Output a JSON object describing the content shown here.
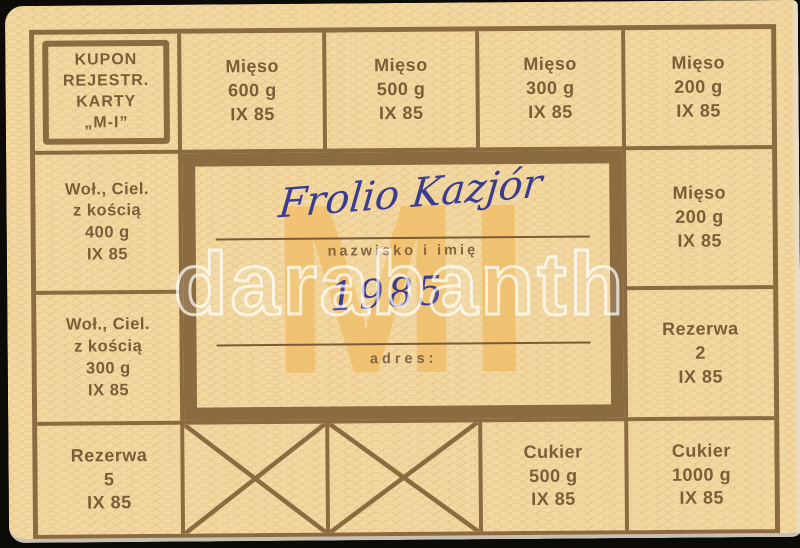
{
  "card": {
    "title_box": {
      "lines": [
        "KUPON",
        "REJESTR.",
        "KARTY",
        "„M-I”"
      ]
    },
    "coupons": {
      "top": [
        [
          "Mięso",
          "600 g",
          "IX 85"
        ],
        [
          "Mięso",
          "500 g",
          "IX 85"
        ],
        [
          "Mięso",
          "300 g",
          "IX 85"
        ],
        [
          "Mięso",
          "200 g",
          "IX 85"
        ]
      ],
      "left": [
        [
          "Woł., Ciel.",
          "z kością",
          "400 g",
          "IX 85"
        ],
        [
          "Woł., Ciel.",
          "z kością",
          "300 g",
          "IX 85"
        ]
      ],
      "right": [
        [
          "Mięso",
          "200 g",
          "IX 85"
        ],
        [
          "Rezerwa",
          "2",
          "IX 85"
        ]
      ],
      "bottom_left": [
        "Rezerwa",
        "5",
        "IX 85"
      ],
      "bottom_right": [
        [
          "Cukier",
          "500 g",
          "IX 85"
        ],
        [
          "Cukier",
          "1000 g",
          "IX 85"
        ]
      ],
      "crossed_out_count": 2
    },
    "center": {
      "signature": "Frolio Kazjór",
      "name_label": "nazwisko i imię",
      "year": "1985",
      "address_label": "adres:",
      "background_letters": "MI"
    },
    "watermark": "darabanth",
    "colors": {
      "card_bg": "#f3d9a1",
      "grid_brown": "#8d6b41",
      "text_brown": "#7c5d38",
      "accent_yellow": "#f0bd67",
      "ink_blue": "#3a3c92",
      "photo_bg": "#0d0b08"
    }
  }
}
